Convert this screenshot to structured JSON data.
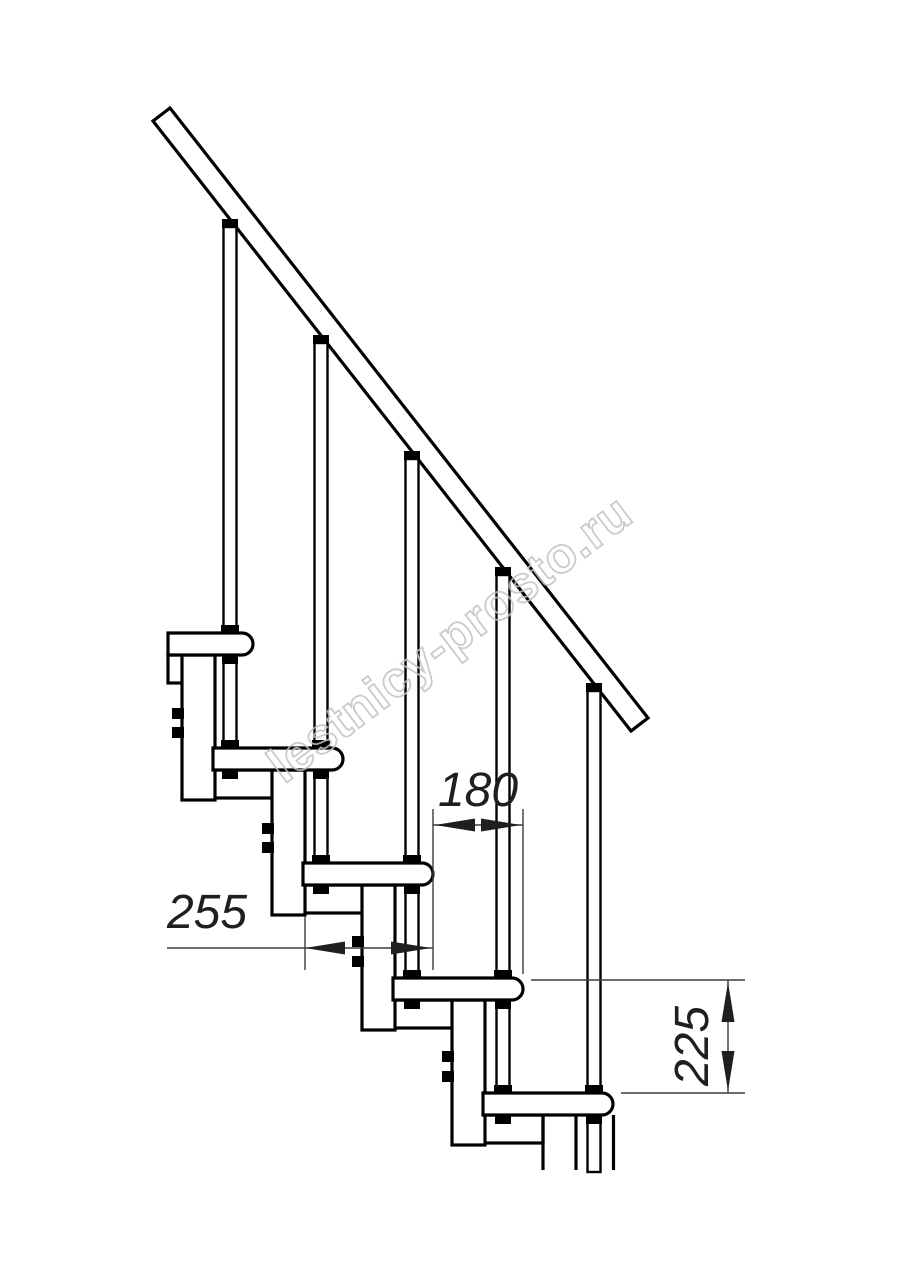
{
  "watermark": {
    "text": "lestnicy-prosto.ru",
    "color": "#c2c2c2"
  },
  "dimensions": {
    "tread_depth": {
      "value": "255",
      "orientation": "horizontal"
    },
    "step_run": {
      "value": "180",
      "orientation": "horizontal"
    },
    "step_rise": {
      "value": "225",
      "orientation": "vertical"
    }
  },
  "drawing": {
    "subject": "modular staircase side elevation with handrail and balusters",
    "line_color": "#000000",
    "dimension_color": "#1f1f1f",
    "background": "#ffffff",
    "tread_count_visible": 5,
    "baluster_count_visible": 5
  }
}
